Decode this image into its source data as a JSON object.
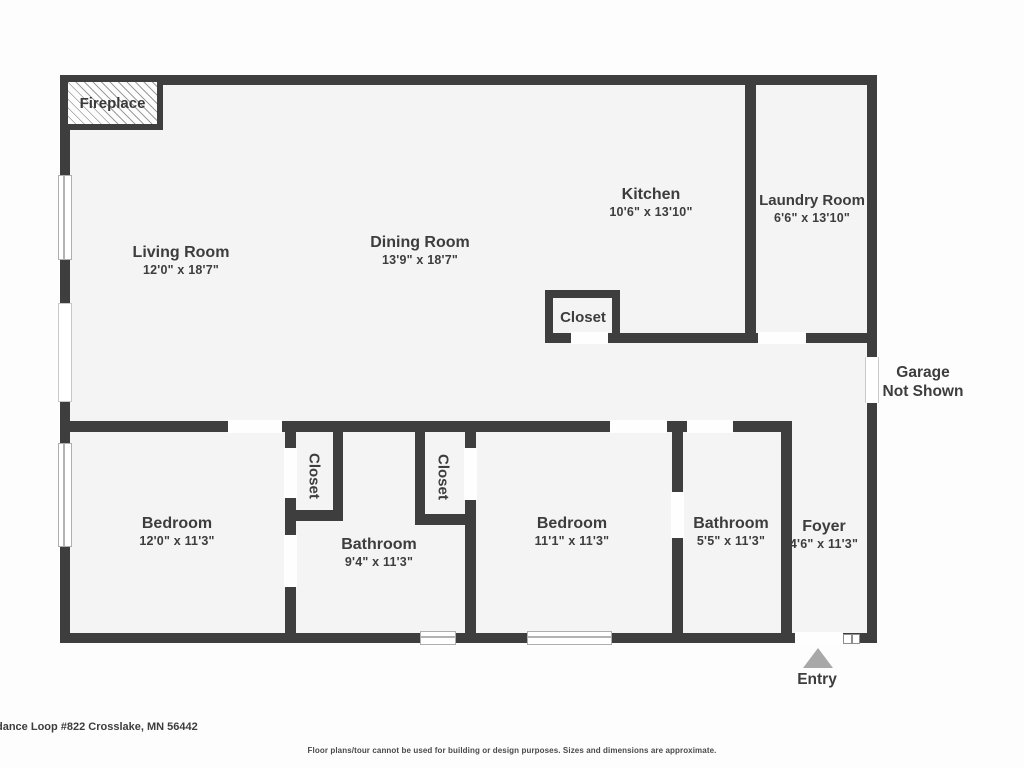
{
  "title": "Floor plan",
  "colors": {
    "wall": "#3e3e3e",
    "floor": "#f4f4f4",
    "background": "#fdfdfd",
    "text": "#3d3d3d",
    "entry_arrow": "#a8a8a8"
  },
  "rooms": {
    "living": {
      "name": "Living Room",
      "dims": "12'0\" x 18'7\""
    },
    "dining": {
      "name": "Dining Room",
      "dims": "13'9\" x 18'7\""
    },
    "kitchen": {
      "name": "Kitchen",
      "dims": "10'6\" x 13'10\""
    },
    "laundry": {
      "name": "Laundry Room",
      "dims": "6'6\" x 13'10\""
    },
    "closet_hall": {
      "name": "Closet"
    },
    "bedroom1": {
      "name": "Bedroom",
      "dims": "12'0\" x 11'3\""
    },
    "closet1": {
      "name": "Closet"
    },
    "closet2": {
      "name": "Closet"
    },
    "bathroom1": {
      "name": "Bathroom",
      "dims": "9'4\" x 11'3\""
    },
    "bedroom2": {
      "name": "Bedroom",
      "dims": "11'1\" x 11'3\""
    },
    "bathroom2": {
      "name": "Bathroom",
      "dims": "5'5\" x 11'3\""
    },
    "foyer": {
      "name": "Foyer",
      "dims": "4'6\" x 11'3\""
    }
  },
  "annotations": {
    "fireplace": "Fireplace",
    "garage_line1": "Garage",
    "garage_line2": "Not Shown",
    "entry": "Entry"
  },
  "footer": {
    "address": "dance Loop #822 Crosslake, MN 56442",
    "disclaimer": "Floor plans/tour cannot be used for building or design purposes. Sizes and dimensions are approximate."
  }
}
